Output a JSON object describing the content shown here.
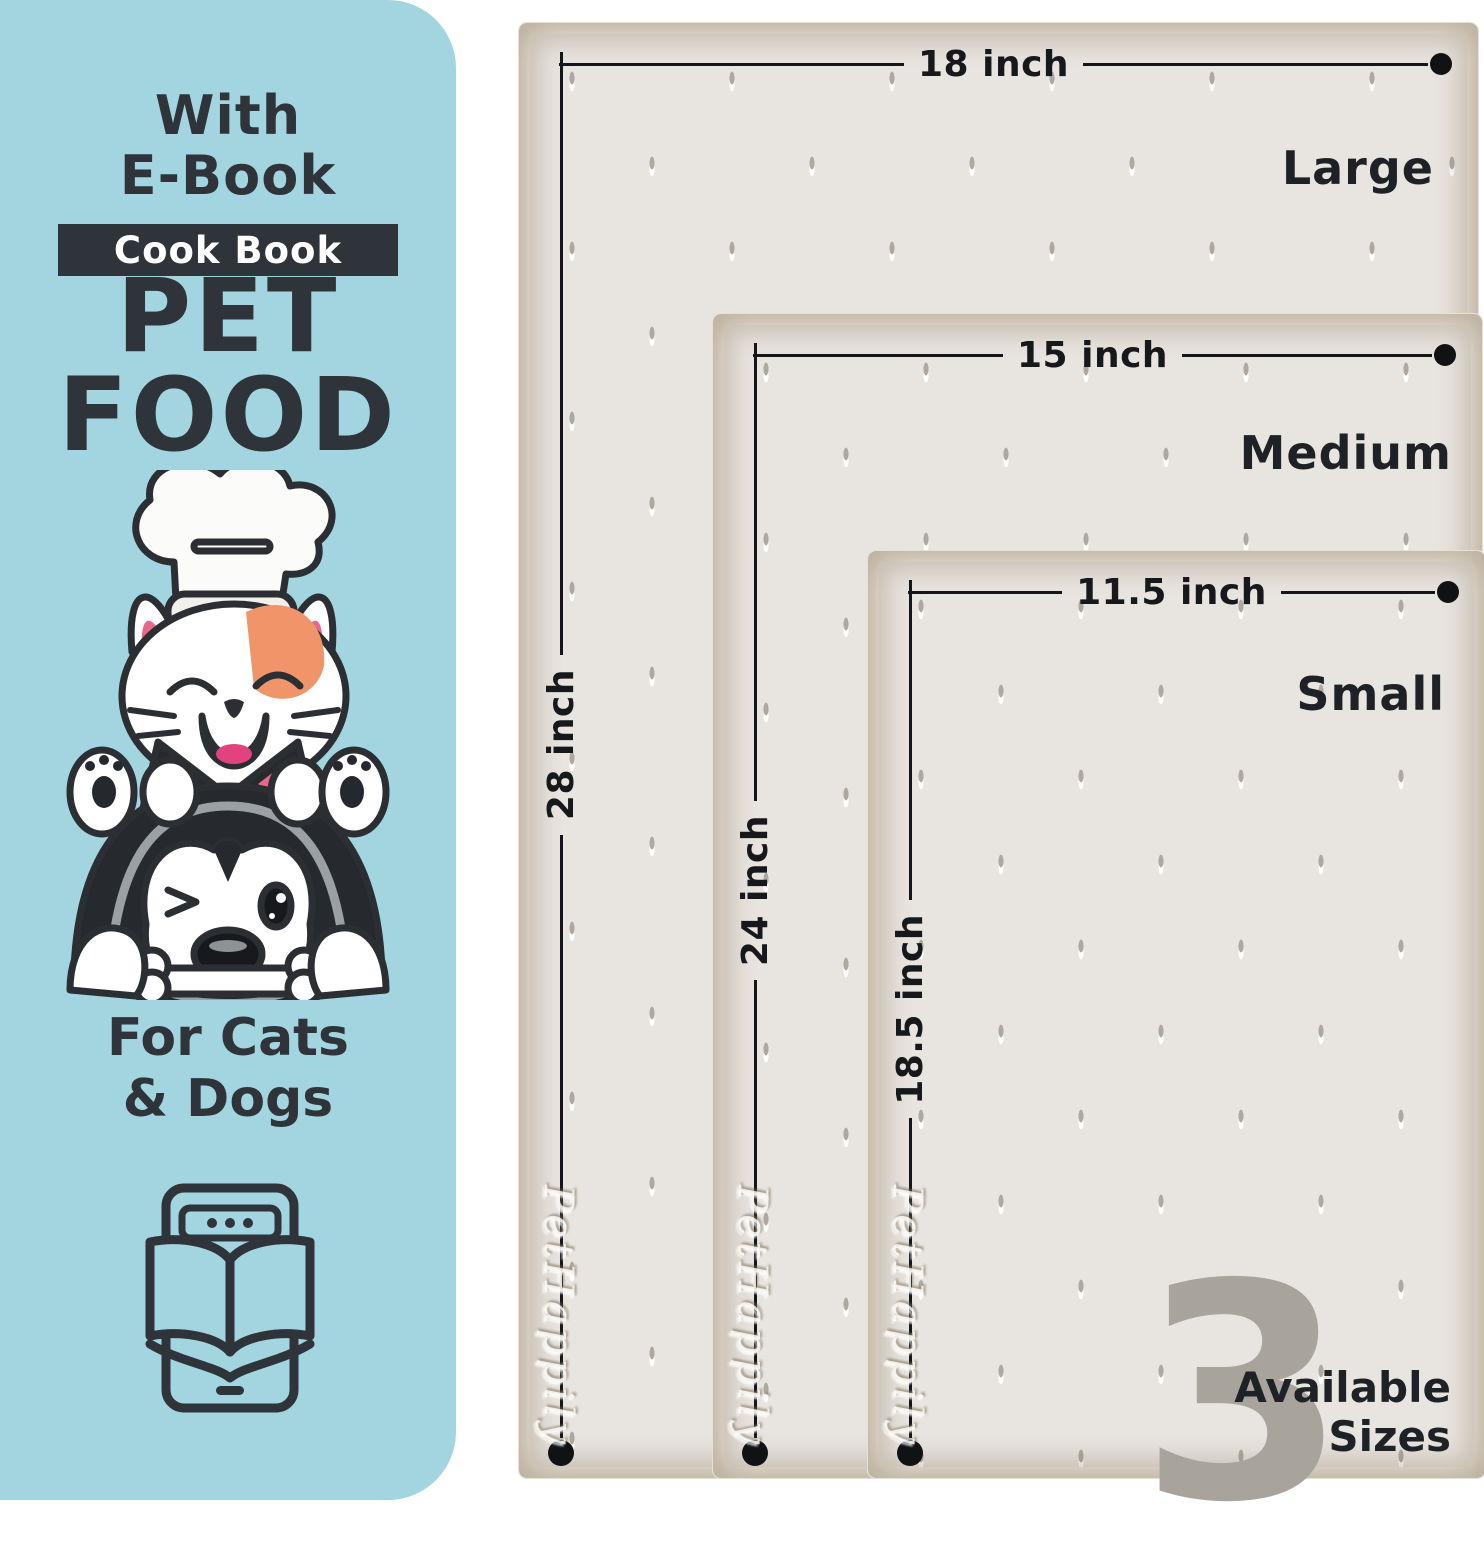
{
  "panel": {
    "line1": "With",
    "line2": "E-Book",
    "badge": "Cook Book",
    "title_line1": "PET",
    "title_line2": "FOOD",
    "audience_line1": "For Cats",
    "audience_line2": "& Dogs"
  },
  "mats": [
    {
      "name": "Large",
      "width": "18 inch",
      "height": "28 inch"
    },
    {
      "name": "Medium",
      "width": "15 inch",
      "height": "24 inch"
    },
    {
      "name": "Small",
      "width": "11.5 inch",
      "height": "18.5 inch"
    }
  ],
  "watermark": "PetHappily",
  "sizes_badge": {
    "count": "3",
    "line1": "Available",
    "line2": "Sizes"
  },
  "icons": {
    "illustration": "cat-and-dog-chef-illustration",
    "ebook": "ebook-tablet-icon"
  },
  "colors": {
    "panel_bg": "#a2d5df",
    "ink": "#2f343a",
    "badge_bg": "#2f343a",
    "badge_text": "#ffffff",
    "mat_surface": "#e8e4df",
    "mat_rim": "#f5f1e9",
    "dimension_line": "#14161a",
    "count_gray": "#a8a49c",
    "cat_patch": "#f0946a",
    "pink": "#e8688c"
  }
}
